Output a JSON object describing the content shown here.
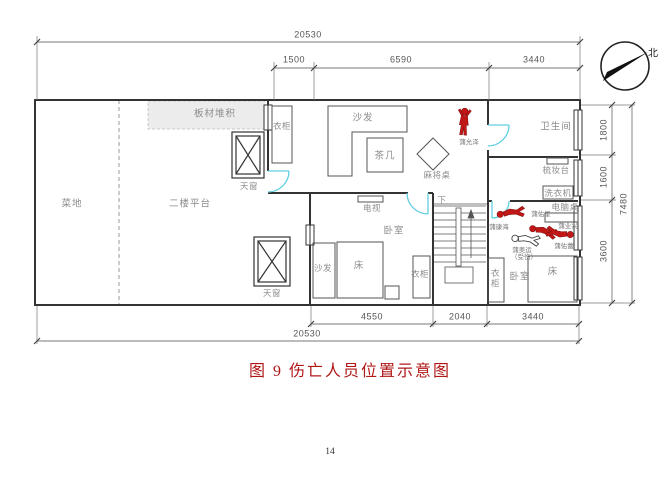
{
  "caption": "图 9  伤亡人员位置示意图",
  "page_number": "14",
  "compass": {
    "north_label": "北"
  },
  "dimensions": {
    "top": {
      "total": "20530",
      "segments": [
        "1500",
        "6590",
        "3440"
      ]
    },
    "bottom": {
      "total": "20530",
      "segments": [
        "4550",
        "2040",
        "3440"
      ]
    },
    "right": {
      "total": "7480",
      "segments": [
        "1800",
        "1600",
        "3600"
      ]
    }
  },
  "rooms": {
    "vegetable_plot": "菜地",
    "second_floor_platform": "二楼平台",
    "board_stack": "板材堆积",
    "skylight_top": "天窗",
    "skylight_bottom": "天窗",
    "wardrobe_living": "衣柜",
    "sofa_living": "沙发",
    "tea_table": "茶几",
    "mahjong_table": "麻将桌",
    "bathroom": "卫生间",
    "dressing_table": "梳妆台",
    "washing_machine": "洗衣机",
    "tv": "电视",
    "stairs_down": "下",
    "computer_desk": "电脑桌",
    "bedroom_mid": "卧室",
    "sofa_mid": "沙发",
    "bed_mid": "床",
    "wardrobe_mid": "衣柜",
    "wardrobe_right": "衣柜",
    "bedroom_right": "卧室",
    "bed_right": "床"
  },
  "casualties": {
    "victim1": "蒲允泽",
    "victim2": "蒲佑星",
    "victim3": "蒲康海",
    "victim4": "蒲业兴",
    "victim5": "蒲佑蕾",
    "victim6_name": "蒲奥运",
    "victim6_status": "（受伤）"
  },
  "colors": {
    "wall": "#333333",
    "door": "#62cfe0",
    "casualty_red": "#c21717",
    "caption_red": "#b01818",
    "dim_gray": "#777777",
    "label_gray": "#8c8c8c"
  }
}
